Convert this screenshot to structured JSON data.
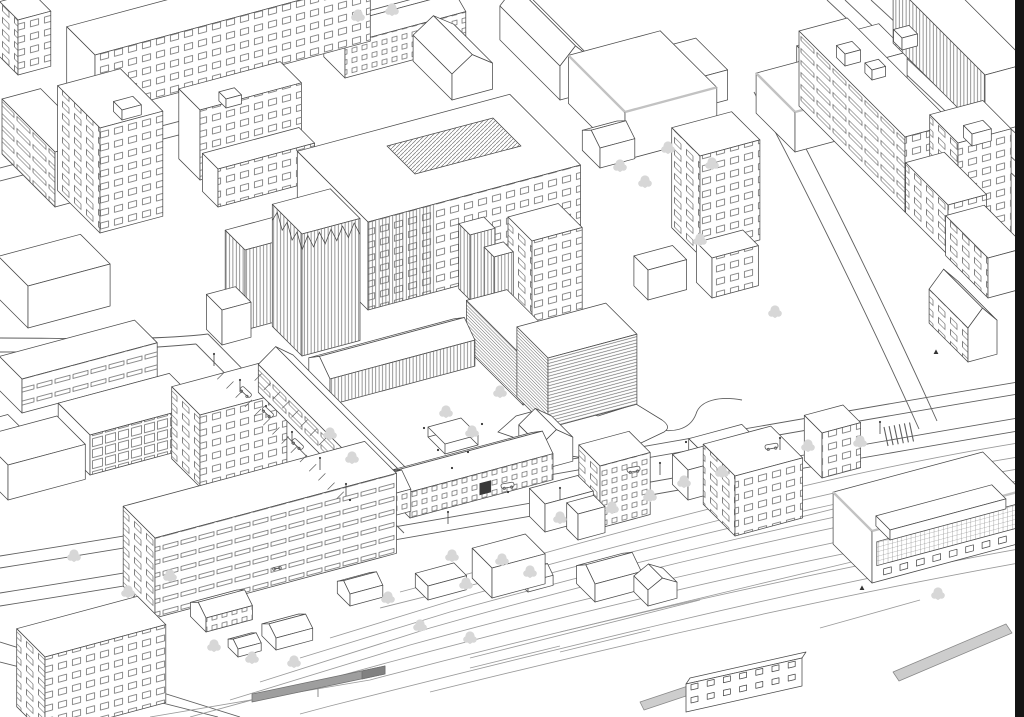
{
  "scene": {
    "kind": "axonometric-architectural-site-drawing",
    "palette": {
      "background": "#ffffff",
      "line": "#4a4a4a",
      "line_soft": "#8f8f8f",
      "street": "#5f5f5f",
      "rail": "#9a9a9a",
      "tree": "#d7d7d7",
      "trunk": "#c6c6c6",
      "train": "#9e9e9e",
      "train_dark": "#818181",
      "platform": "#cdcdcd",
      "fascia": "#c2c2c2",
      "figure": "#333333",
      "entrance": "#3a3a3a",
      "border": "#141414"
    },
    "features": [
      "city-blocks",
      "campus-tower",
      "campus-north-slab",
      "courtyard-wings",
      "courtyard-canopy",
      "cross-shaped-building",
      "street-network",
      "parking-bays",
      "railway-yard",
      "station-building",
      "platforms",
      "train",
      "trees",
      "parked-cars",
      "street-lamps",
      "pedestrians"
    ]
  }
}
